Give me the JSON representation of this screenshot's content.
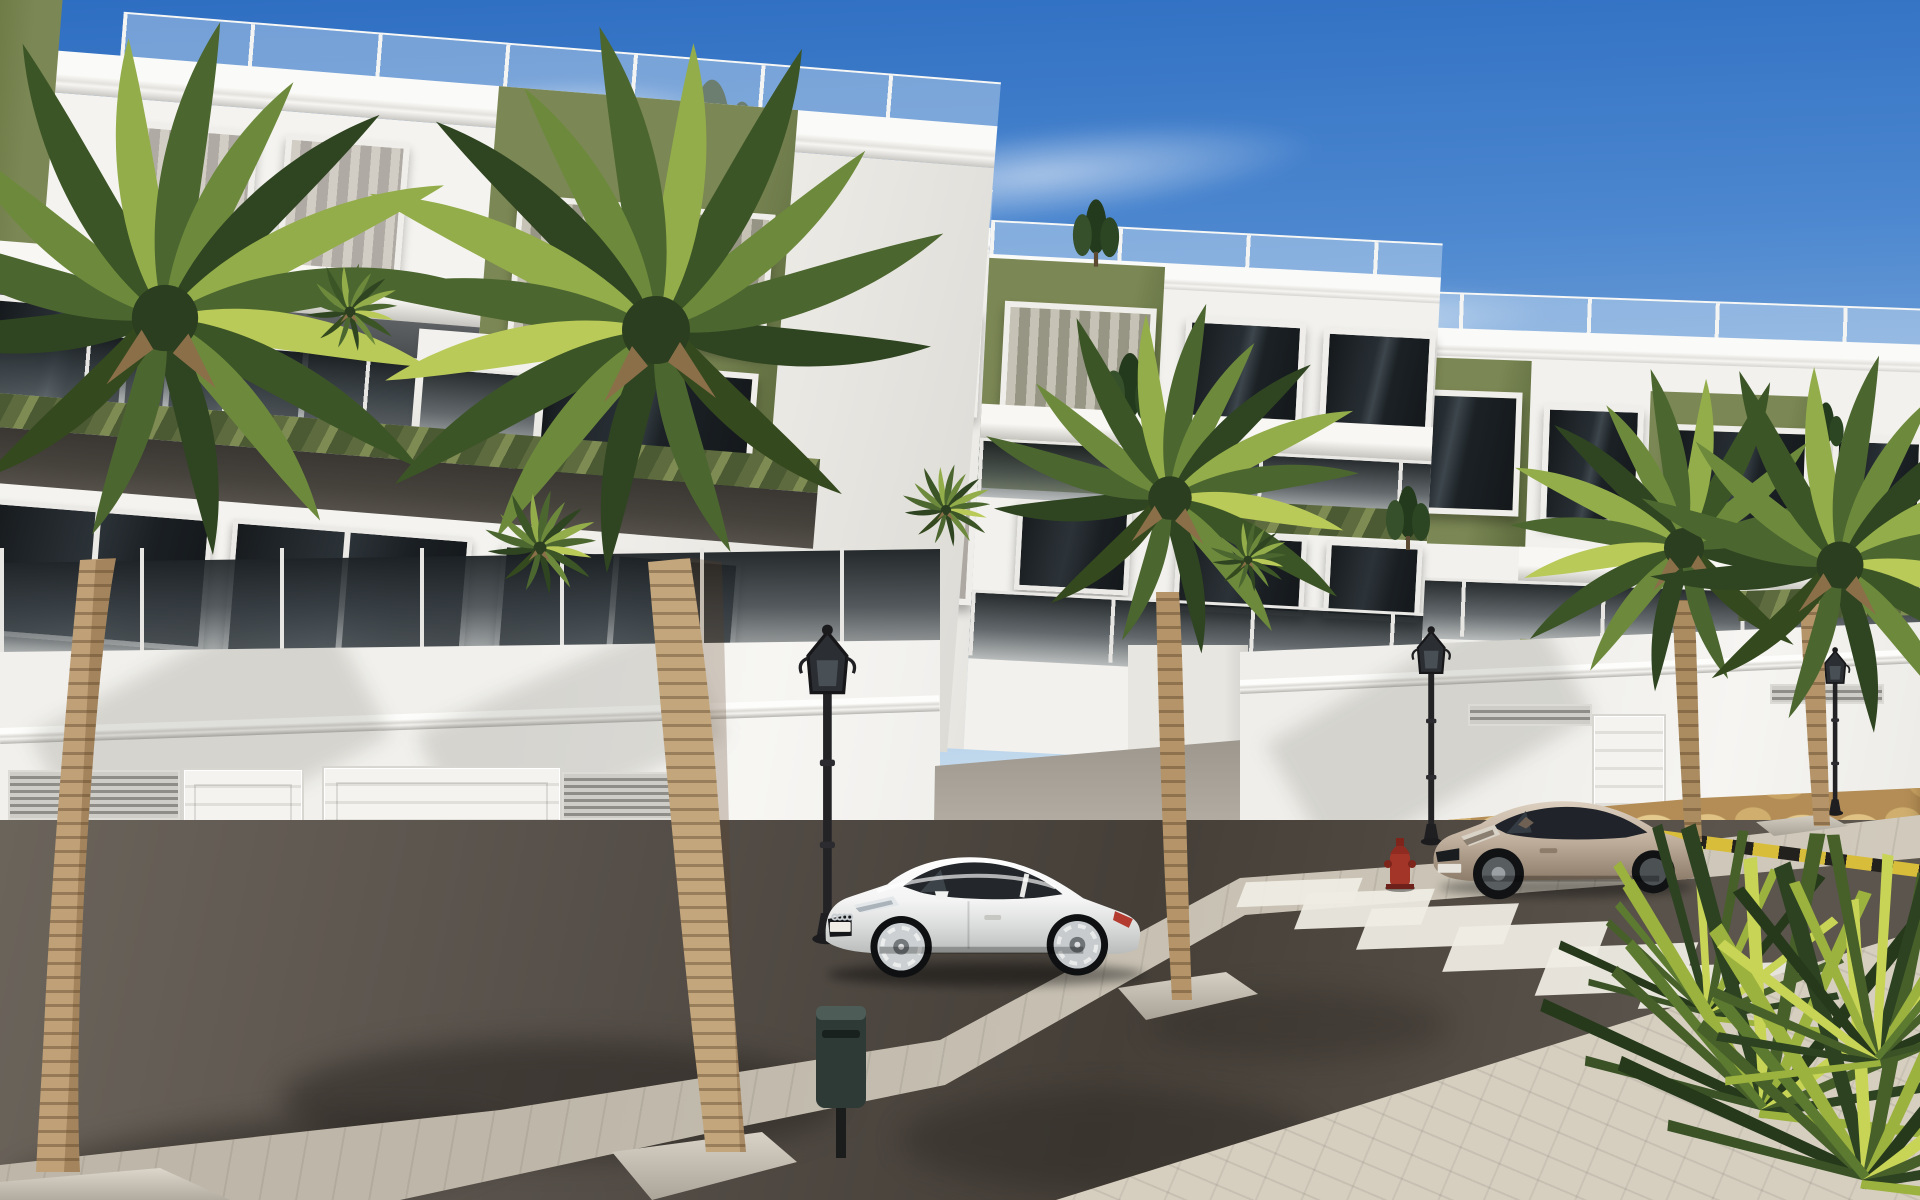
{
  "scene": {
    "type": "architectural-render",
    "description": "Sunny 3D street render of a modern white-and-olive three-storey apartment complex with glass balconies, stone-clad garage walls, two parked coupes, a zebra crosswalk, ornate street lamps and palm trees",
    "sky": {
      "clouds": 4
    },
    "buildings": [
      {
        "id": "left-foreground",
        "floors": 3,
        "accent_color_name": "olive-green",
        "roof_glass_railing": true,
        "garage_doors": 2,
        "vent_grilles": 2,
        "pergola_louvers": true
      },
      {
        "id": "middle",
        "floors": 3,
        "accent_color_name": "olive-green",
        "roof_glass_railing": true,
        "garage_doors": 1,
        "vent_grilles": 2,
        "pergola_louvers": true
      },
      {
        "id": "far-right",
        "floors": 3,
        "accent_color_name": "olive-green",
        "roof_glass_railing": true,
        "vent_grilles": 1,
        "pergola_louvers": true
      }
    ],
    "street": {
      "crosswalk_stripes": 7,
      "hazard_marking": "yellow-black striped line",
      "street_lamps": 3,
      "fire_hydrant": 1,
      "litter_bin": 1,
      "driveway_ramp": 1,
      "surfaces": [
        "asphalt road",
        "paver sidewalk",
        "stone veneer wall bases"
      ]
    },
    "vehicles": [
      {
        "type": "coupe",
        "model_look": "Audi TT style",
        "color_name": "white",
        "facing": "left"
      },
      {
        "type": "coupe",
        "model_look": "Renault Megane style",
        "color_name": "beige-champagne",
        "facing": "left"
      }
    ],
    "vegetation": {
      "large_foreground_palms": 2,
      "street_palms": 3,
      "foreground_palm_bush": 1,
      "rooftop_shrubs": 5,
      "balcony_plants": 4
    }
  },
  "colors": {
    "sky-top": "#2e6ec2",
    "sky-mid": "#7fabdc",
    "sky-low": "#dceaf4",
    "wall-white": "#f2f1ed",
    "wall-shade": "#e2e0db",
    "green-accent": "#7b8754",
    "green-dark": "#5b693c",
    "pergola-dark": "#4c5a34",
    "frame-white": "#f0eeea",
    "garage-door": "#f4f3ef",
    "stone-base": "#b38d55",
    "sidewalk": "#c8c1b3",
    "paver": "#d6cfc0",
    "ramp": "#c3bdb3",
    "asphalt": "#57504a",
    "asphalt-dark": "#453f38",
    "stripe-white": "#efece3",
    "hazard-yellow": "#d8bd3a",
    "hazard-black": "#23211e",
    "trunk-light": "#c3a67c",
    "trunk-dark": "#8a6c49",
    "frond-dark": "#2f4521",
    "frond-mid": "#4c6630",
    "frond-light": "#93ad4a",
    "frond-bright": "#c7d455",
    "lamp-black": "#26262a",
    "hydrant-red": "#a23527",
    "car-white": "#fafaf8",
    "car-beige": "#bfae9c",
    "glass-dark": "#181d20"
  }
}
